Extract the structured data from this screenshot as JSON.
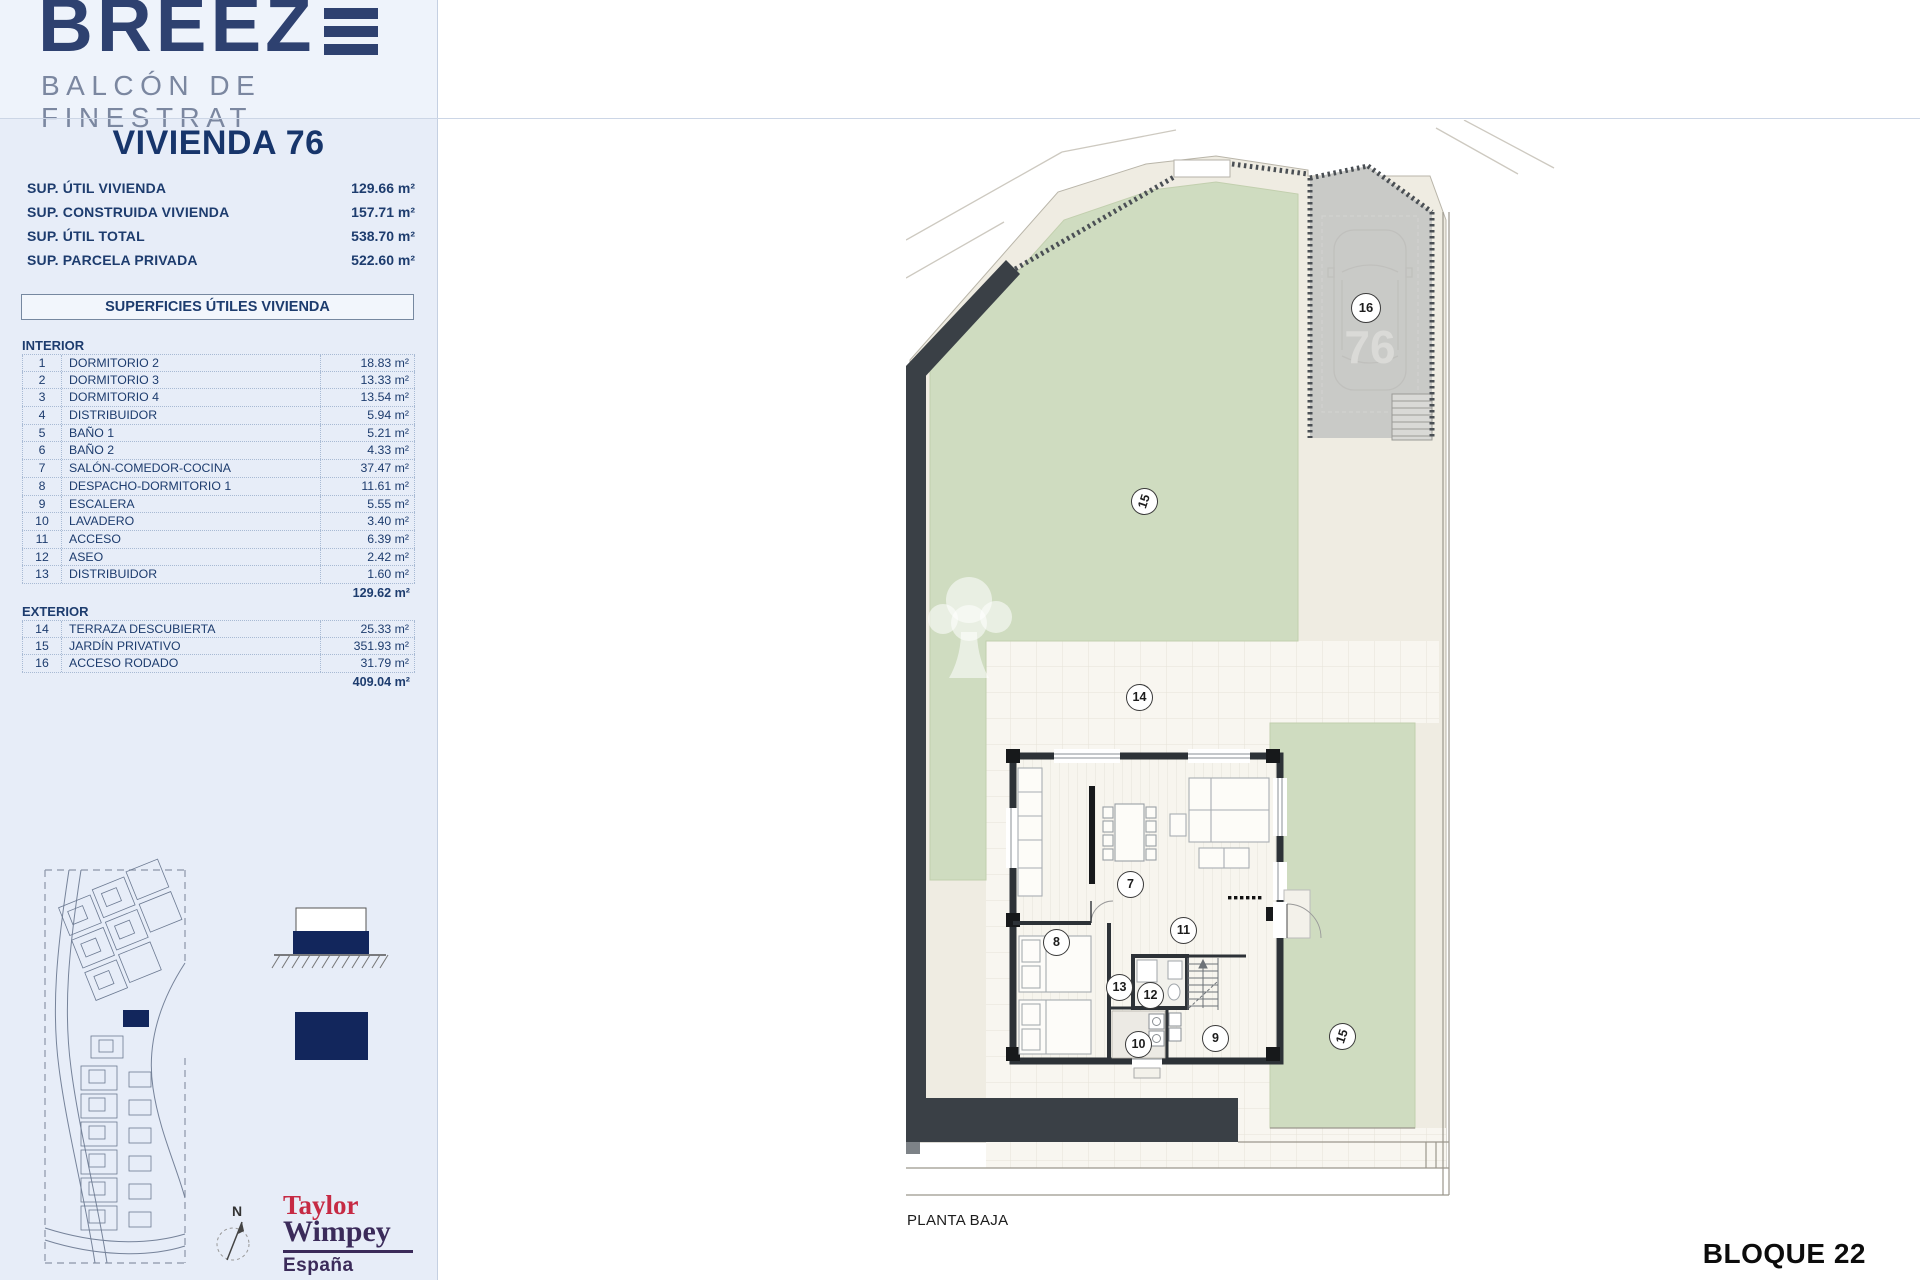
{
  "brand": {
    "logo_text": "BREEZ",
    "logo_icon": "triple-bar-e",
    "subtitle": "BALCÓN DE FINESTRAT"
  },
  "sidebar": {
    "title": "VIVIENDA 76",
    "summary": [
      {
        "label": "SUP. ÚTIL VIVIENDA",
        "value": "129.66 m²"
      },
      {
        "label": "SUP. CONSTRUIDA VIVIENDA",
        "value": "157.71 m²"
      },
      {
        "label": "SUP. ÚTIL TOTAL",
        "value": "538.70 m²"
      },
      {
        "label": "SUP. PARCELA PRIVADA",
        "value": "522.60 m²"
      }
    ],
    "table": {
      "header": "SUPERFICIES ÚTILES VIVIENDA",
      "interior": {
        "name": "INTERIOR",
        "rows": [
          {
            "num": "1",
            "label": "DORMITORIO 2",
            "value": "18.83 m²"
          },
          {
            "num": "2",
            "label": "DORMITORIO 3",
            "value": "13.33 m²"
          },
          {
            "num": "3",
            "label": "DORMITORIO 4",
            "value": "13.54 m²"
          },
          {
            "num": "4",
            "label": "DISTRIBUIDOR",
            "value": "5.94 m²"
          },
          {
            "num": "5",
            "label": "BAÑO 1",
            "value": "5.21 m²"
          },
          {
            "num": "6",
            "label": "BAÑO 2",
            "value": "4.33 m²"
          },
          {
            "num": "7",
            "label": "SALÓN-COMEDOR-COCINA",
            "value": "37.47 m²"
          },
          {
            "num": "8",
            "label": "DESPACHO-DORMITORIO 1",
            "value": "11.61 m²"
          },
          {
            "num": "9",
            "label": "ESCALERA",
            "value": "5.55 m²"
          },
          {
            "num": "10",
            "label": "LAVADERO",
            "value": "3.40 m²"
          },
          {
            "num": "11",
            "label": "ACCESO",
            "value": "6.39 m²"
          },
          {
            "num": "12",
            "label": "ASEO",
            "value": "2.42 m²"
          },
          {
            "num": "13",
            "label": "DISTRIBUIDOR",
            "value": "1.60 m²"
          }
        ],
        "subtotal": "129.62 m²"
      },
      "exterior": {
        "name": "EXTERIOR",
        "rows": [
          {
            "num": "14",
            "label": "TERRAZA DESCUBIERTA",
            "value": "25.33 m²"
          },
          {
            "num": "15",
            "label": "JARDÍN PRIVATIVO",
            "value": "351.93 m²"
          },
          {
            "num": "16",
            "label": "ACCESO RODADO",
            "value": "31.79 m²"
          }
        ],
        "subtotal": "409.04 m²"
      }
    },
    "north_label": "N",
    "developer": {
      "line1": "Taylor",
      "line2": "Wimpey",
      "line3": "España"
    }
  },
  "plan": {
    "floor_label": "PLANTA BAJA",
    "block_label": "BLOQUE 22",
    "plot_number": "76",
    "markers": {
      "m7": "7",
      "m8": "8",
      "m9": "9",
      "m10": "10",
      "m11": "11",
      "m12": "12",
      "m13": "13",
      "m14": "14",
      "m15_garden": "15",
      "m15_side": "15",
      "m16": "16"
    }
  },
  "colors": {
    "brand_navy": "#2e4170",
    "text_navy": "#1d3c6e",
    "sidebar_bg": "#e7edf8",
    "garden_green": "#cfdcc0",
    "garage_gray": "#c9cac7",
    "wall_dark": "#3a4046",
    "highlight_navy": "#12265c",
    "taylor_red": "#c62a44",
    "wimpey_purple": "#3b2b5a"
  }
}
